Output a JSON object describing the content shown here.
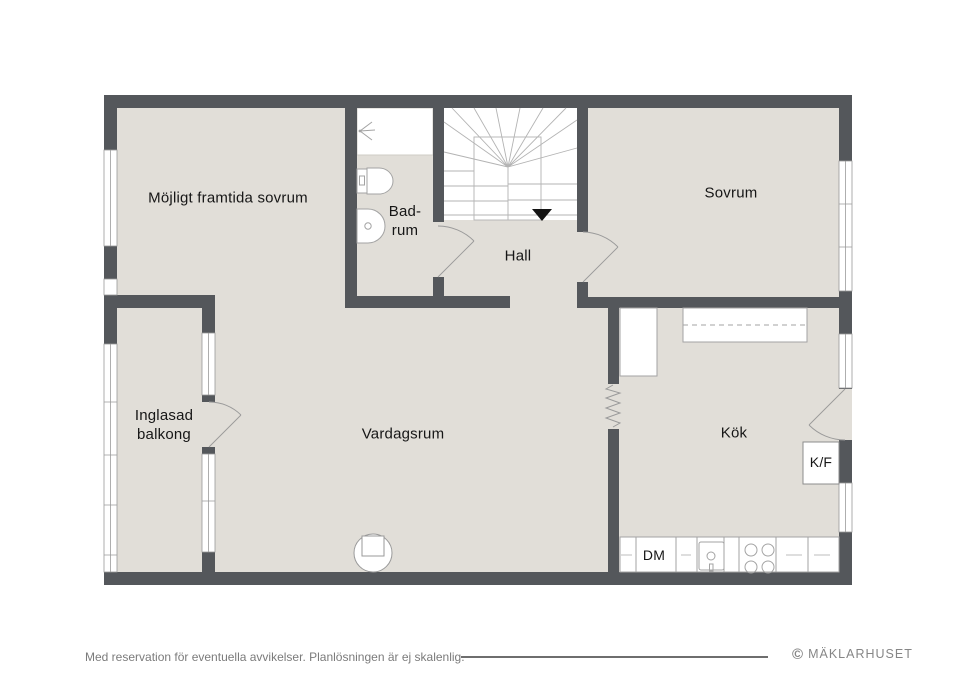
{
  "colors": {
    "wall": "#54575b",
    "floor": "#e1ded8",
    "fixture_line": "#a3a3a3",
    "label_text": "#161616",
    "footer_text": "#7b7b7b"
  },
  "floorplan": {
    "rooms": [
      {
        "label": "Möjligt framtida sovrum"
      },
      {
        "label": "Bad-\nrum"
      },
      {
        "label": "Hall"
      },
      {
        "label": "Sovrum"
      },
      {
        "label": "Inglasad\nbalkong"
      },
      {
        "label": "Vardagsrum"
      },
      {
        "label": "Kök"
      }
    ],
    "appliances": [
      {
        "label": "K/F"
      },
      {
        "label": "DM"
      }
    ]
  },
  "footer": {
    "disclaimer": "Med reservation för eventuella avvikelser. Planlösningen är ej skalenlig.",
    "brand_symbol": "©",
    "brand_name": "MÄKLARHUSET"
  }
}
